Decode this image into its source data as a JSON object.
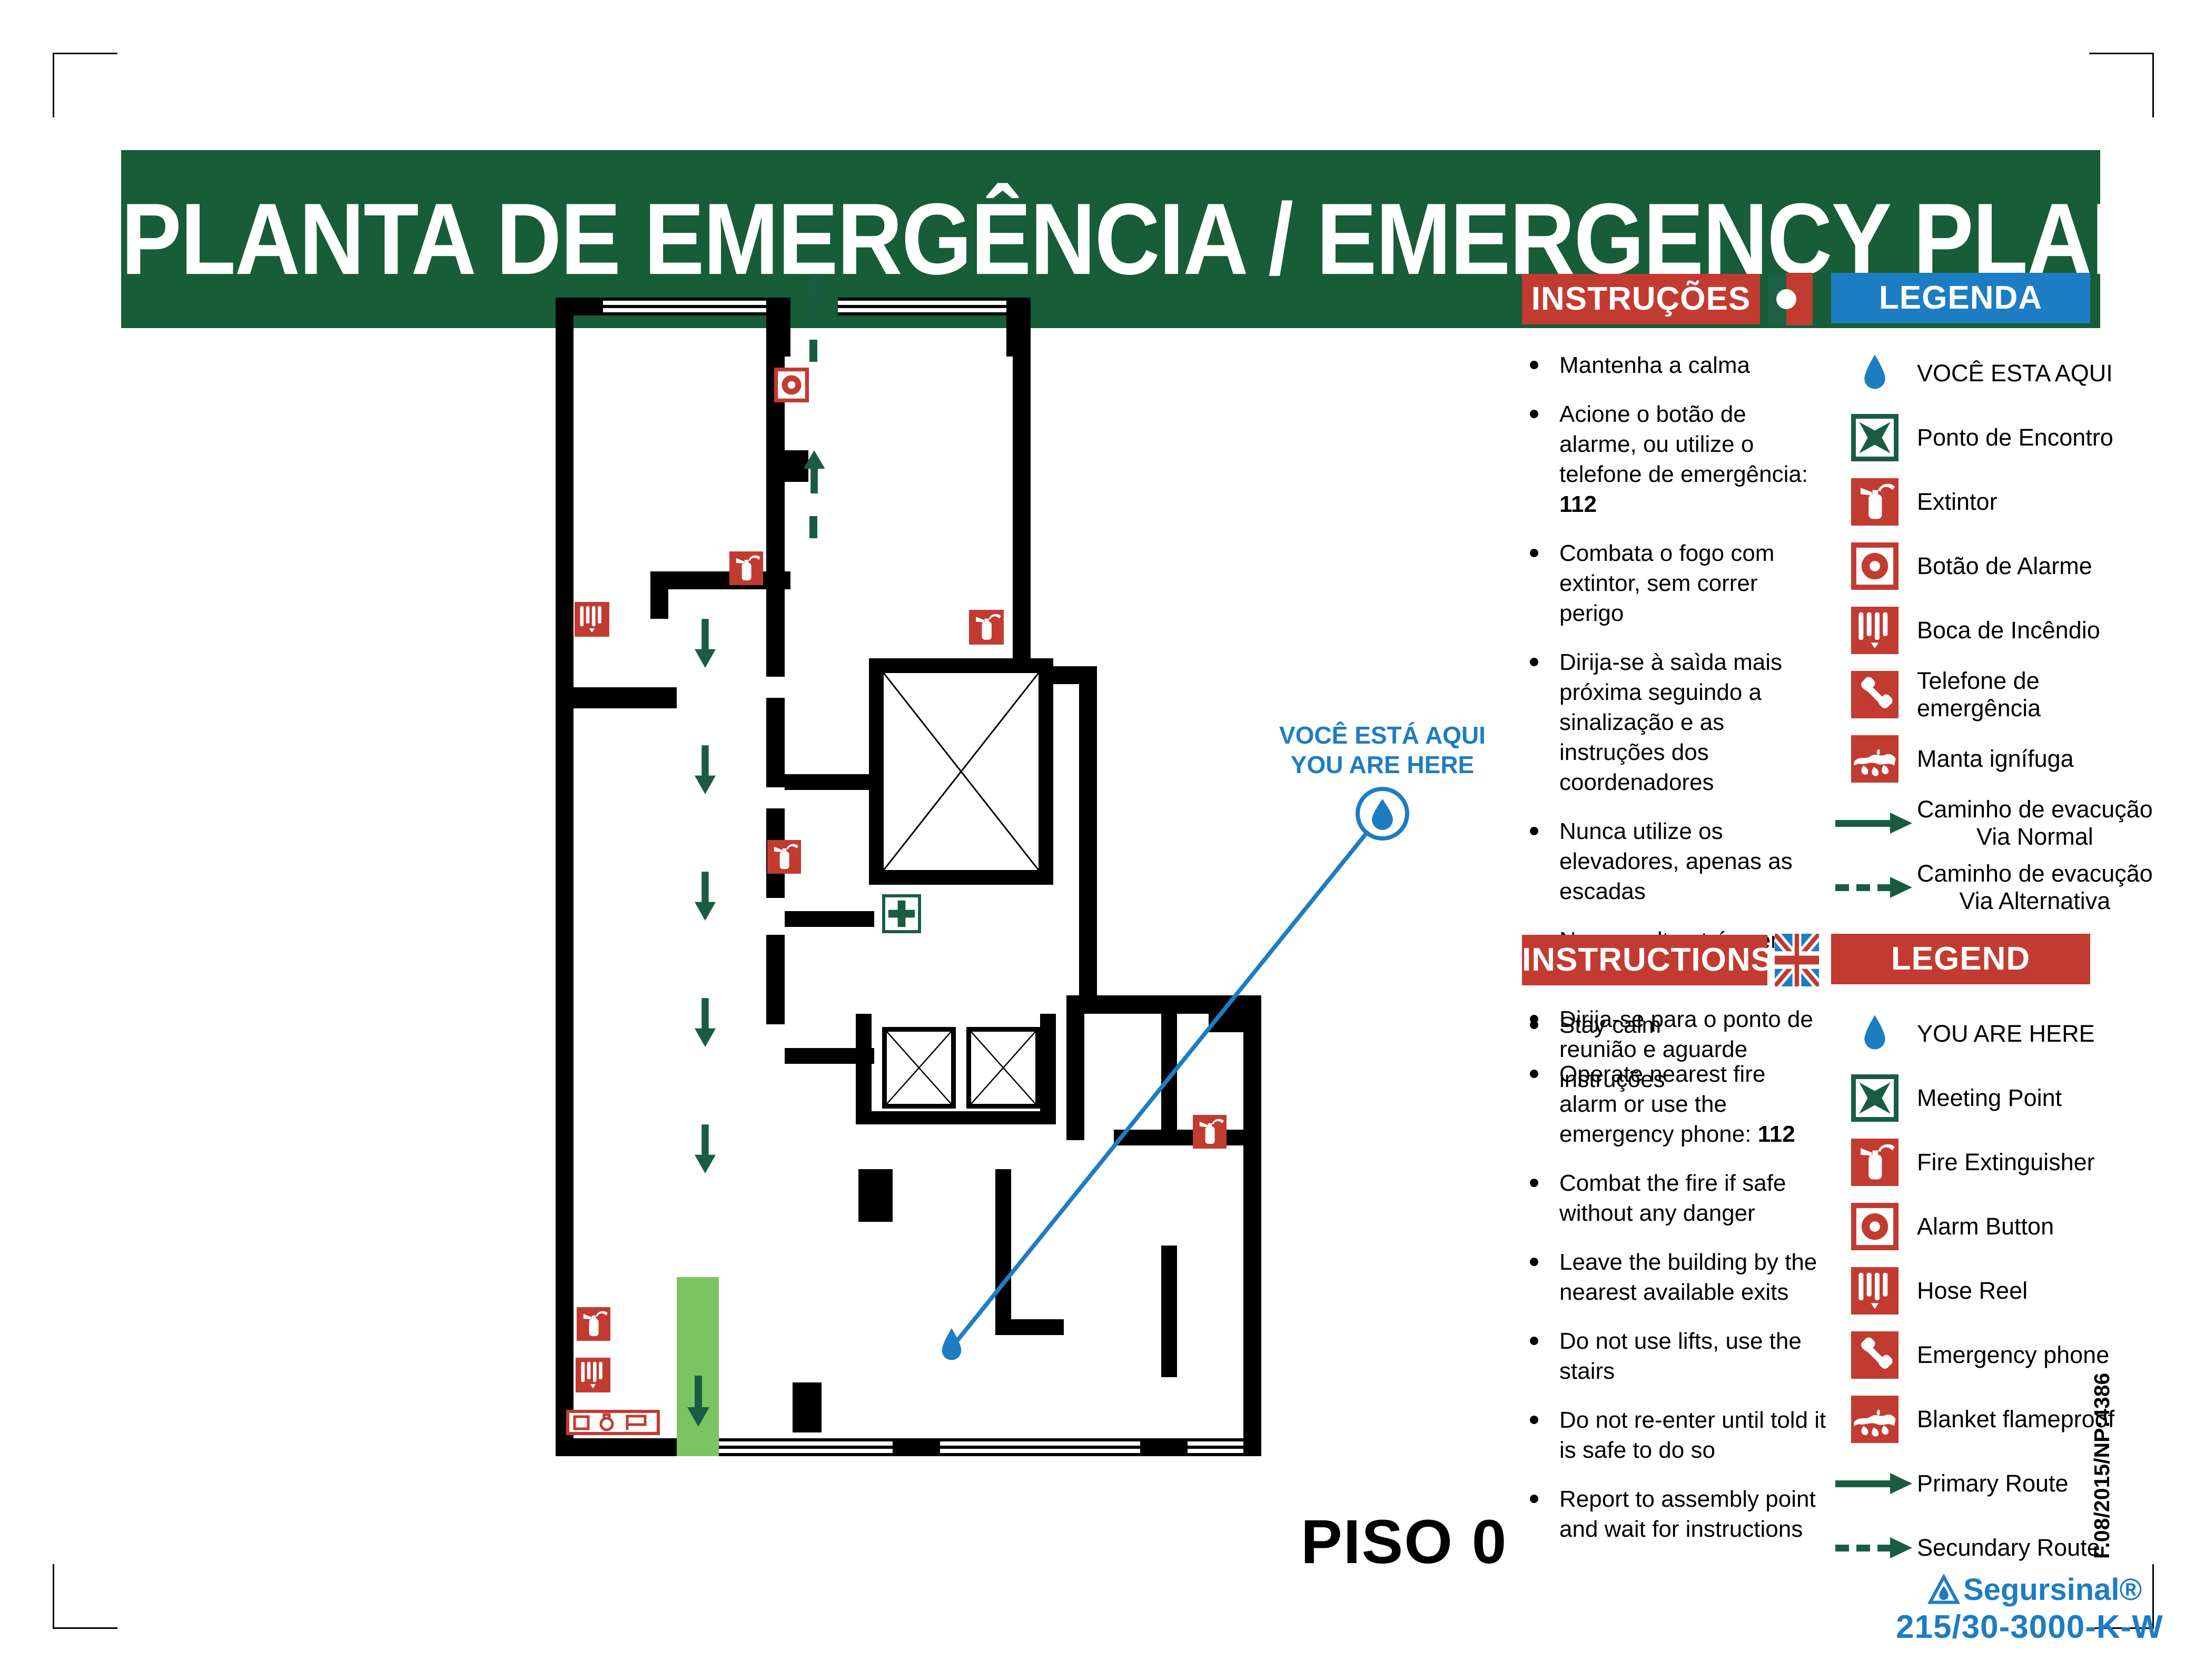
{
  "page": {
    "title_banner": "PLANTA DE EMERGÊNCIA / EMERGENCY PLAN",
    "floor_label": "PISO 0",
    "doc_ref": "F.08/2015/NP:4386"
  },
  "you_are_here": {
    "line1": "VOCÊ ESTÁ AQUI",
    "line2": "YOU ARE HERE"
  },
  "brand": {
    "name": "Segursinal®",
    "code": "215/30-3000-K-W"
  },
  "colors": {
    "header_green": "#175d38",
    "red": "#c23b31",
    "blue": "#1d7dc2",
    "icon_green": "#1a5c42",
    "exit_green": "#7cc463"
  },
  "panels": {
    "pt": {
      "instructions_title": "INSTRUÇÕES",
      "legend_title": "LEGENDA",
      "flag": "portugal-flag",
      "instructions": [
        {
          "text": "Mantenha a calma"
        },
        {
          "text": "Acione o botão de alarme, ou utilize o telefone de emergência: ",
          "strong": "112"
        },
        {
          "text": "Combata o fogo com extintor, sem correr perigo"
        },
        {
          "text": "Dirija-se à saìda mais próxima seguindo a sinalização e as instruções dos coordenadores"
        },
        {
          "text": "Nunca utilize os elevadores, apenas as escadas"
        },
        {
          "text": "Nunca volte atrás sem autorização"
        },
        {
          "text": "Dirija-se para o ponto de reunião e aguarde instruções"
        }
      ],
      "legend": [
        {
          "icon": "you-are-here-droplet",
          "label": "VOCÊ ESTA AQUI"
        },
        {
          "icon": "meeting-point",
          "label": "Ponto de Encontro"
        },
        {
          "icon": "fire-extinguisher",
          "label": "Extintor"
        },
        {
          "icon": "alarm-button",
          "label": "Botão de Alarme"
        },
        {
          "icon": "hose-reel",
          "label": "Boca de Incêndio"
        },
        {
          "icon": "emergency-phone",
          "label": "Telefone de emergência"
        },
        {
          "icon": "fire-blanket",
          "label": "Manta ignífuga"
        },
        {
          "icon": "route-primary",
          "label": "Caminho de evacução",
          "label2": "Via Normal"
        },
        {
          "icon": "route-secondary",
          "label": "Caminho de evacução",
          "label2": "Via Alternativa"
        }
      ]
    },
    "en": {
      "instructions_title": "INSTRUCTIONS",
      "legend_title": "LEGEND",
      "flag": "uk-flag",
      "instructions": [
        {
          "text": "Stay calm"
        },
        {
          "text": "Operate nearest fire alarm or use the emergency phone: ",
          "strong": "112"
        },
        {
          "text": "Combat the fire if safe without any danger"
        },
        {
          "text": "Leave the building by the nearest available exits"
        },
        {
          "text": "Do not use lifts, use the stairs"
        },
        {
          "text": "Do not re-enter until told it is safe to do so"
        },
        {
          "text": "Report to assembly point and wait for instructions"
        }
      ],
      "legend": [
        {
          "icon": "you-are-here-droplet",
          "label": "YOU ARE HERE"
        },
        {
          "icon": "meeting-point",
          "label": "Meeting Point"
        },
        {
          "icon": "fire-extinguisher",
          "label": "Fire Extinguisher"
        },
        {
          "icon": "alarm-button",
          "label": "Alarm Button"
        },
        {
          "icon": "hose-reel",
          "label": "Hose Reel"
        },
        {
          "icon": "emergency-phone",
          "label": "Emergency phone"
        },
        {
          "icon": "fire-blanket",
          "label": "Blanket flameproof"
        },
        {
          "icon": "route-primary",
          "label": "Primary Route"
        },
        {
          "icon": "route-secondary",
          "label": "Secundary Route"
        }
      ]
    }
  }
}
